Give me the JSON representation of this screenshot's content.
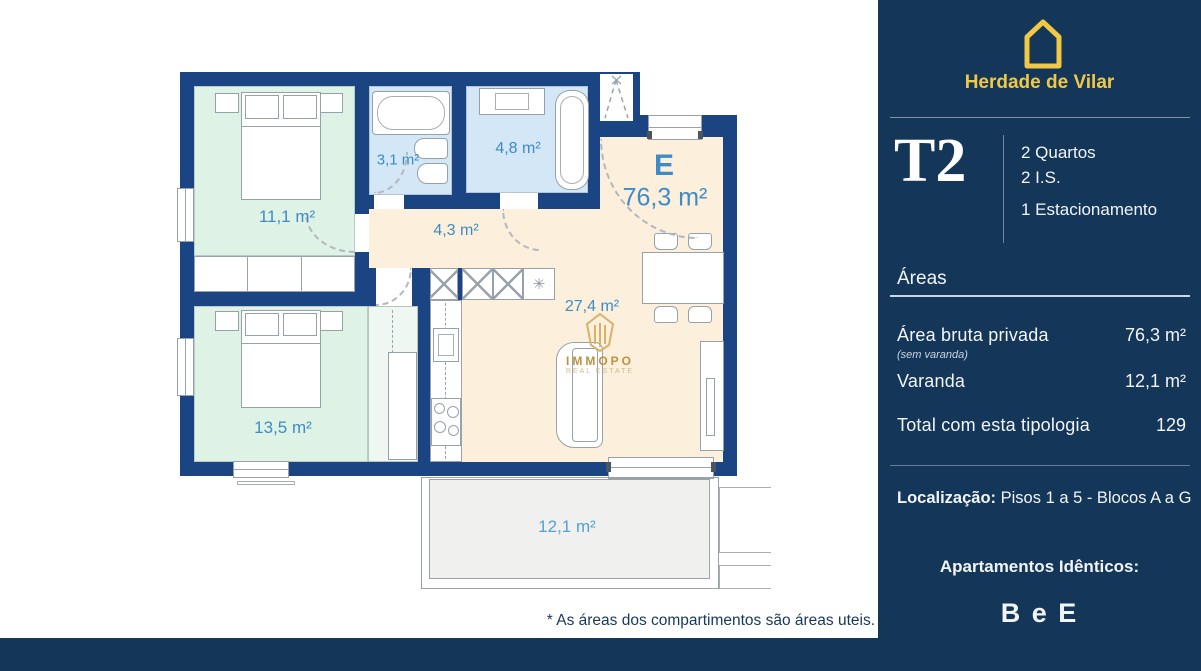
{
  "colors": {
    "sidebar_navy": "#143659",
    "wall_navy": "#1b4483",
    "accent_yellow": "#f0c845",
    "room_label_blue": "#3e8bc8",
    "bedroom_green": "#dff2e6",
    "bathroom_blue": "#d3e7f7",
    "living_peach": "#fcefdc",
    "balcony_gray": "#f0f0ee"
  },
  "floorplan": {
    "unit_letter": "E",
    "unit_area": "76,3 m²",
    "rooms": {
      "bedroom1": "11,1 m²",
      "bathroom1": "3,1 m²",
      "bathroom2": "4,8 m²",
      "hall": "4,3 m²",
      "bedroom2": "13,5 m²",
      "living": "27,4 m²",
      "balcony": "12,1 m²"
    },
    "watermark": {
      "title": "IMMOPO",
      "subtitle": "REAL ESTATE"
    },
    "footnote": "* As áreas dos compartimentos são áreas uteis."
  },
  "sidebar": {
    "brand": "Herdade de Vilar",
    "typology_code": "T2",
    "features": {
      "bedrooms": "2 Quartos",
      "bathrooms": "2 I.S.",
      "parking": "1 Estacionamento"
    },
    "areas_title": "Áreas",
    "rows": [
      {
        "label": "Área bruta privada",
        "note": "(sem varanda)",
        "value": "76,3 m²"
      },
      {
        "label": "Varanda",
        "value": "12,1 m²"
      },
      {
        "label": "Total com esta tipologia",
        "value": "129"
      }
    ],
    "location_label": "Localização:",
    "location_value": "Pisos 1 a 5 - Blocos A a G",
    "identical_label": "Apartamentos Idênticos:",
    "identical_value": "B e E"
  }
}
